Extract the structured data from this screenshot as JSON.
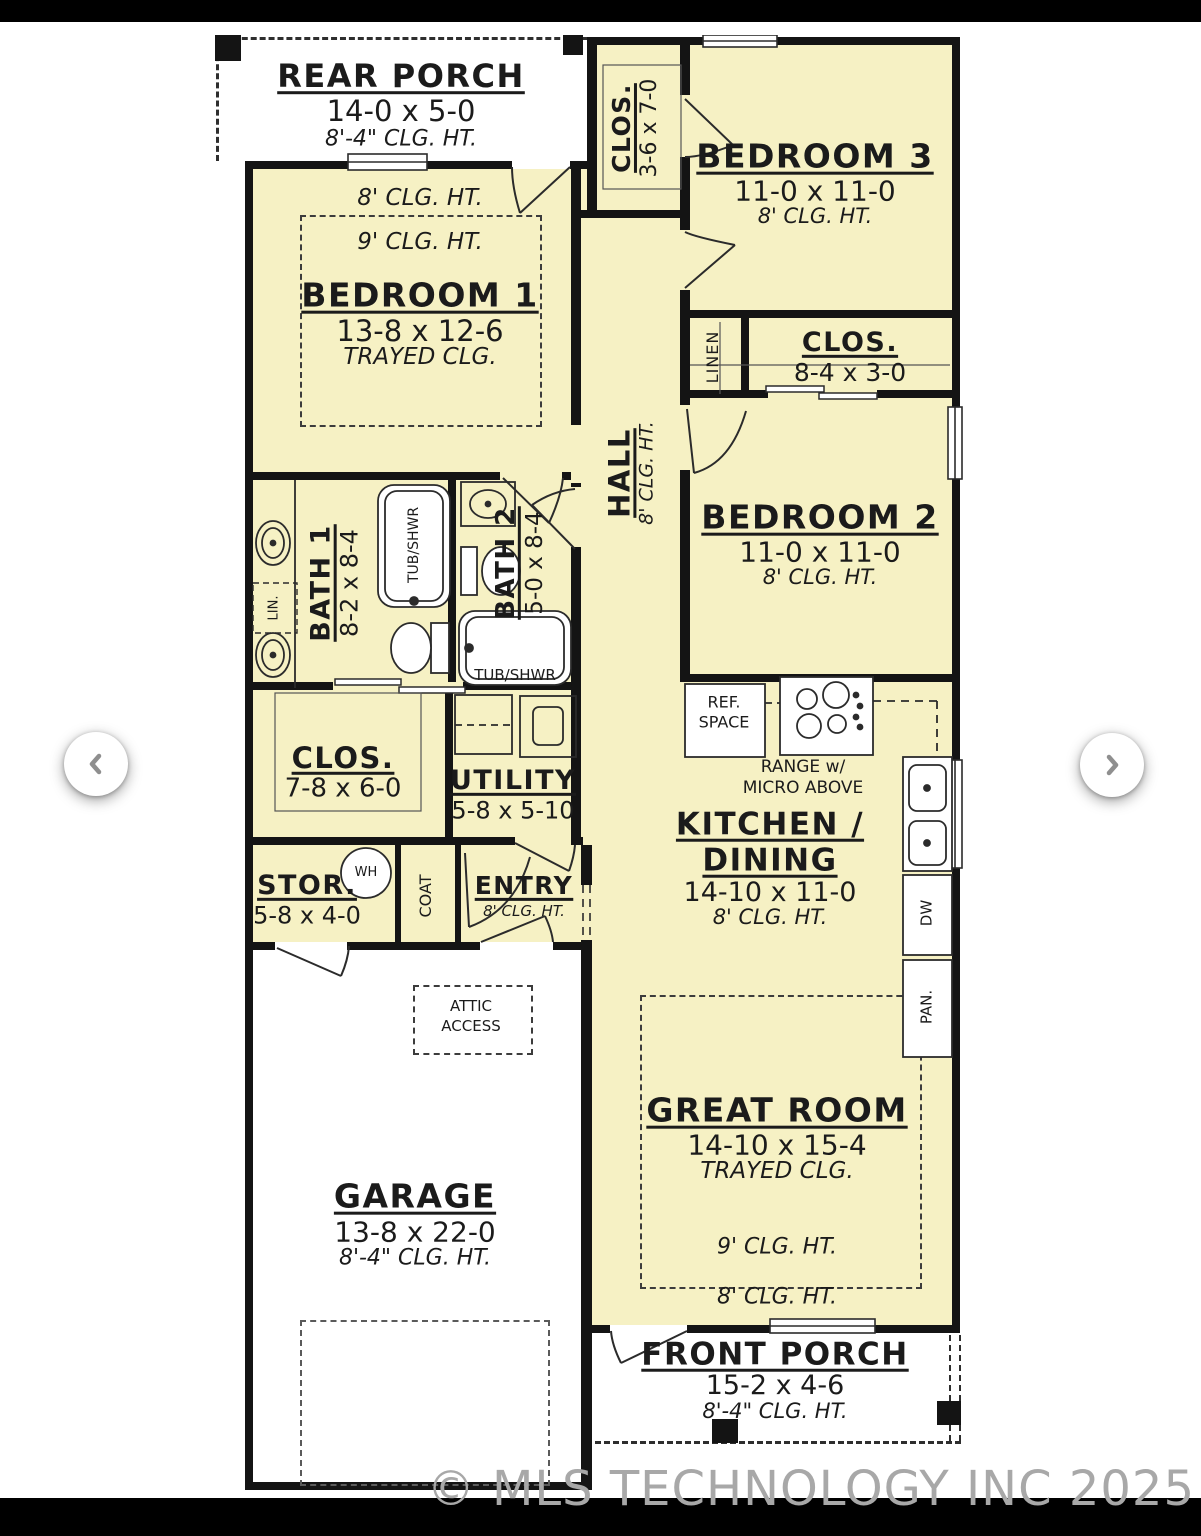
{
  "watermark": "© MLS TECHNOLOGY INC 2025",
  "colors": {
    "room_fill": "#f6f1c4",
    "wall": "#141414",
    "watermark": "#a8a8a8"
  },
  "plan": {
    "rear_porch": {
      "title": "REAR PORCH",
      "dims": "14-0 x 5-0",
      "ceiling": "8'-4\" CLG. HT."
    },
    "bedroom1": {
      "title": "BEDROOM 1",
      "dims": "13-8 x 12-6",
      "note": "TRAYED CLG.",
      "clg8": "8' CLG. HT.",
      "clg9": "9' CLG. HT."
    },
    "closet_bed3": {
      "title": "CLOS.",
      "dims": "3-6 x 7-0"
    },
    "bedroom3": {
      "title": "BEDROOM 3",
      "dims": "11-0 x 11-0",
      "ceiling": "8' CLG. HT."
    },
    "linen": {
      "title": "LINEN"
    },
    "closet_bed2": {
      "title": "CLOS.",
      "dims": "8-4 x 3-0"
    },
    "bedroom2": {
      "title": "BEDROOM 2",
      "dims": "11-0 x 11-0",
      "ceiling": "8' CLG. HT."
    },
    "hall": {
      "title": "HALL",
      "ceiling": "8' CLG. HT."
    },
    "bath1": {
      "title": "BATH 1",
      "dims": "8-2 x 8-4",
      "linen": "LIN.",
      "tub": "TUB/SHWR"
    },
    "bath2": {
      "title": "BATH 2",
      "dims": "5-0 x 8-4",
      "tub": "TUB/SHWR"
    },
    "closet_main": {
      "title": "CLOS.",
      "dims": "7-8 x 6-0"
    },
    "utility": {
      "title": "UTILITY",
      "dims": "5-8 x 5-10"
    },
    "kitchen": {
      "title_line1": "KITCHEN /",
      "title_line2": "DINING",
      "dims": "14-10 x 11-0",
      "ceiling": "8' CLG. HT.",
      "ref_line1": "REF.",
      "ref_line2": "SPACE",
      "range_line1": "RANGE w/",
      "range_line2": "MICRO ABOVE",
      "dishwasher": "DW",
      "pantry": "PAN."
    },
    "storage": {
      "title": "STOR.",
      "dims": "5-8 x 4-0",
      "water_heater": "WH"
    },
    "coat": {
      "title": "COAT"
    },
    "entry": {
      "title": "ENTRY",
      "ceiling": "8' CLG. HT."
    },
    "attic": {
      "line1": "ATTIC",
      "line2": "ACCESS"
    },
    "garage": {
      "title": "GARAGE",
      "dims": "13-8 x 22-0",
      "ceiling": "8'-4\" CLG. HT."
    },
    "great_room": {
      "title": "GREAT ROOM",
      "dims": "14-10 x 15-4",
      "note": "TRAYED CLG.",
      "clg9": "9' CLG. HT.",
      "clg8": "8' CLG. HT."
    },
    "front_porch": {
      "title": "FRONT PORCH",
      "dims": "15-2 x 4-6",
      "ceiling": "8'-4\" CLG. HT."
    }
  }
}
